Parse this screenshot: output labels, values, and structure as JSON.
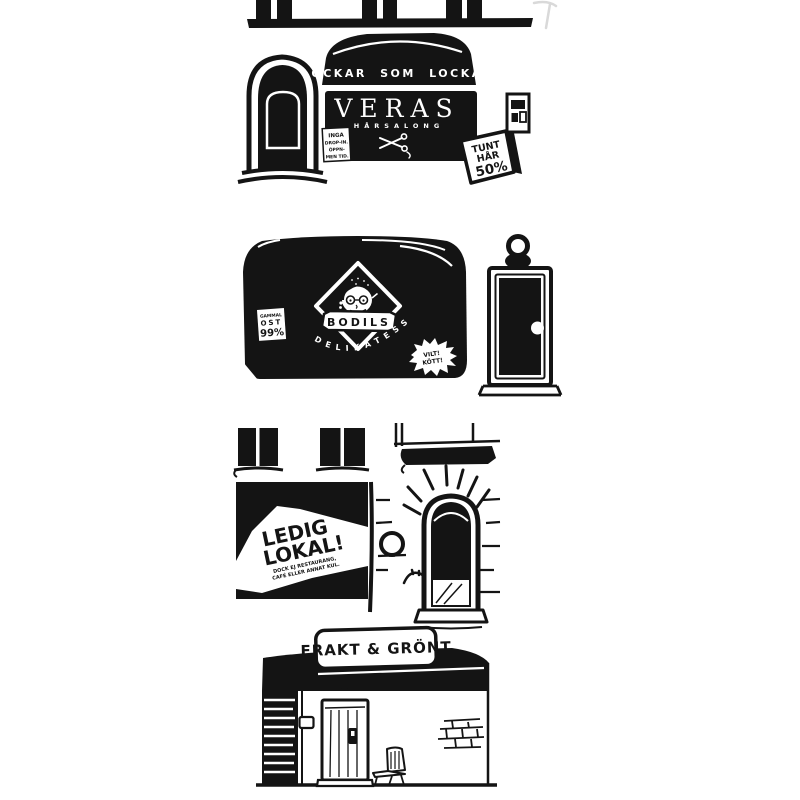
{
  "colors": {
    "ink": "#141414",
    "paper": "#ffffff",
    "sketch": "#d9d9d9"
  },
  "storefronts": {
    "hair_salon": {
      "awning_text": "LOCKAR SOM LOCKAR",
      "name": "VERAS",
      "subtitle": "HÅRSALONG",
      "sticker_lines": [
        "INGA",
        "DROP-IN.",
        "ÖPPN-",
        "MEN TID."
      ],
      "sandwich_board": {
        "line1": "TUNT",
        "line2": "HÅR",
        "line3": "50%"
      }
    },
    "deli": {
      "name": "BODILS",
      "subtitle": "DELIKATESS",
      "price_sticker": {
        "line1": "GAMMAL",
        "line2": "OST",
        "line3": "99%"
      },
      "starburst": {
        "line1": "VILT!",
        "line2": "KÖTT!"
      }
    },
    "vacant_shop": {
      "sign_line1": "LEDIG",
      "sign_line2": "LOKAL!",
      "small_line1": "DOCK EJ RESTAURANG,",
      "small_line2": "CAFÉ ELLER ANNAT KUL."
    },
    "freight_shop": {
      "sign": "FRAKT & GRÖNT"
    }
  }
}
